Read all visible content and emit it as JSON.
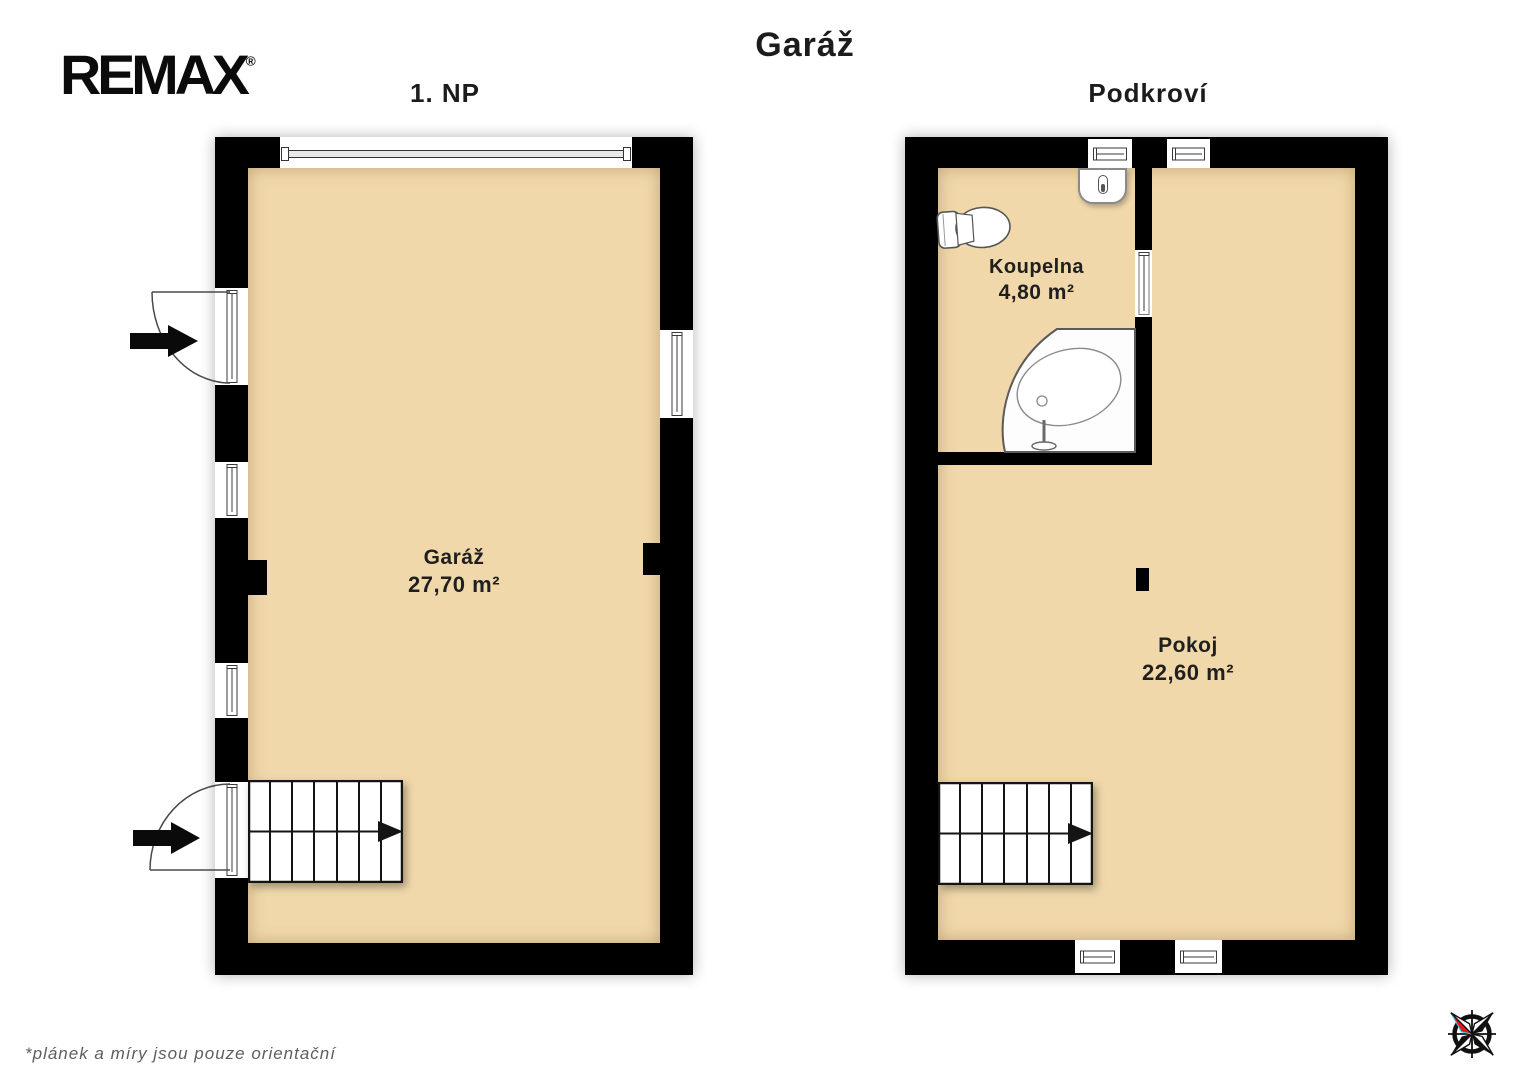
{
  "branding": {
    "logo_text": "REMAX",
    "registered_mark": "®"
  },
  "title": "Garáž",
  "plans": [
    {
      "name": "1. NP",
      "rooms": [
        {
          "label": "Garáž",
          "area": "27,70 m²"
        }
      ]
    },
    {
      "name": "Podkroví",
      "rooms": [
        {
          "label": "Koupelna",
          "area": "4,80 m²"
        },
        {
          "label": "Pokoj",
          "area": "22,60 m²"
        }
      ]
    }
  ],
  "disclaimer": "*plánek a míry jsou pouze orientační",
  "icons": {
    "compass": "compass-rose",
    "toilet": "toilet-top-view",
    "bathtub": "corner-bathtub",
    "water_heater": "water-heater-thermometer",
    "stairs": "staircase-up-arrow",
    "entrance_arrow": "entrance-direction-arrow"
  },
  "colors": {
    "floor_fill": "#f0d8aa",
    "wall": "#000000",
    "label_text": "#1f1f1f",
    "disclaimer_text": "#5d5d64",
    "compass_needle_red": "#e3181e",
    "compass_accent_cyan": "#43c7e8"
  }
}
